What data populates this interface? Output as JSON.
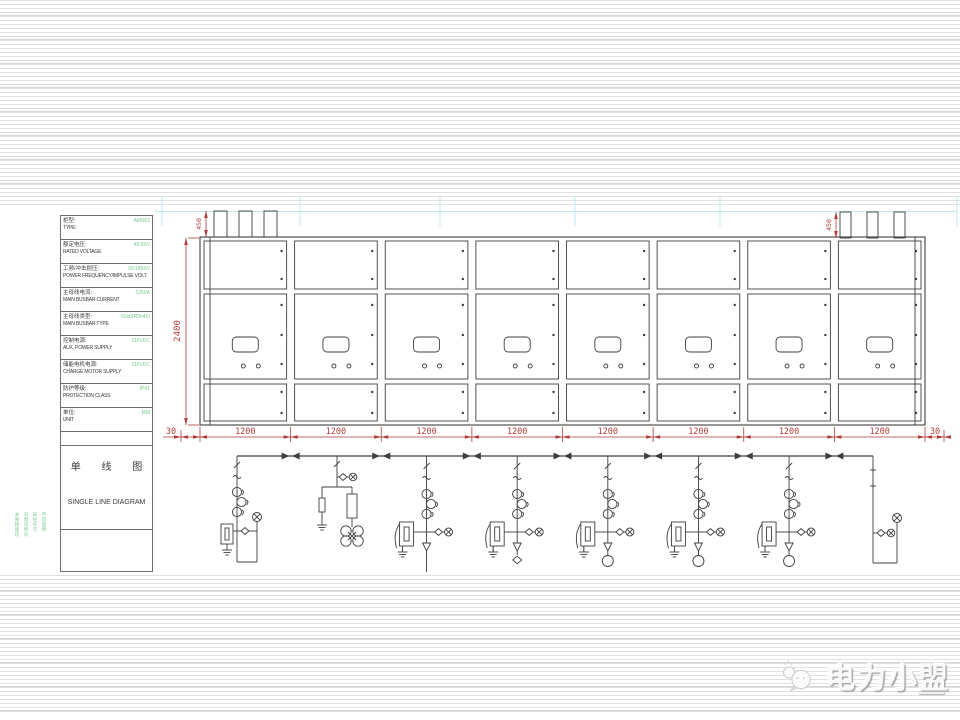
{
  "slide": {
    "background": "#ffffff",
    "stripe_color": "#e0e0e0"
  },
  "watermark": {
    "text": "电力小盟",
    "icon": "chat-bubbles-logo"
  },
  "colors": {
    "dimension_red": "#b03a3a",
    "value_green": "#7ac98f",
    "line_dark": "#3f3f3f",
    "guide_cyan": "#bfe9ec"
  },
  "spec_table": {
    "rows": [
      {
        "label_zh": "柜型:",
        "label_en": "TYPE:",
        "value": "AMS63"
      },
      {
        "label_zh": "额定电压:",
        "label_en": "RATED VOLTAGE",
        "value": "40.5KV"
      },
      {
        "label_zh": "工频/冲击耐压:",
        "label_en": "POWER FREQUENCY/IMPULSE VOLT.",
        "value": "95/185KV"
      },
      {
        "label_zh": "主母线电流:",
        "label_en": "MAIN BUSBAR CURRENT",
        "value": "1250A"
      },
      {
        "label_zh": "主母线类型:",
        "label_en": "MAIN BUSBAR TYPE",
        "value": "60x6(R5h45)"
      },
      {
        "label_zh": "控制电源:",
        "label_en": "AUX. POWER SUPPLY",
        "value": "110VDC"
      },
      {
        "label_zh": "储能电机电源:",
        "label_en": "CHARGE MOTOR SUPPLY",
        "value": "110VDC"
      },
      {
        "label_zh": "防护等级:",
        "label_en": "PROTECTION CLASS",
        "value": "IP41"
      },
      {
        "label_zh": "单位:",
        "label_en": "UNIT",
        "value": "MM"
      }
    ]
  },
  "title_block": {
    "zh": "单 线 图",
    "en": "SINGLE LINE DIAGRAM"
  },
  "side_note_lines": [
    "本图样版权",
    "归我司所有",
    "未经许可",
    "不得复制"
  ],
  "dimensions": {
    "bay_width_labels": [
      "1200",
      "1200",
      "1200",
      "1200",
      "1200",
      "1200",
      "1200",
      "1200"
    ],
    "left_margin": "30",
    "right_margin": "30",
    "overall_height": "2400",
    "bushing_height": "450"
  },
  "elevation": {
    "bays": 8
  },
  "sld": {
    "circuits": [
      {
        "kind": "incoming-left"
      },
      {
        "kind": "pt"
      },
      {
        "kind": "feeder",
        "end": "line"
      },
      {
        "kind": "feeder",
        "end": "diamond"
      },
      {
        "kind": "feeder",
        "end": "circle"
      },
      {
        "kind": "feeder",
        "end": "circle"
      },
      {
        "kind": "feeder",
        "end": "circle"
      },
      {
        "kind": "incoming-right"
      }
    ]
  }
}
